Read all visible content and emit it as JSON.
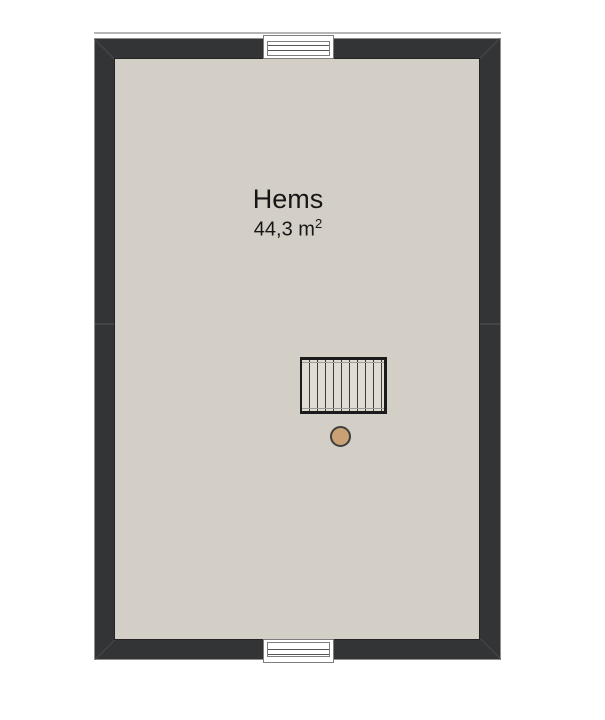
{
  "room": {
    "name": "Hems",
    "area_value": "44,3 m",
    "area_exponent": "2"
  },
  "colors": {
    "background": "#ffffff",
    "wall": "#333436",
    "wall_outline": "#8f8f8f",
    "wall_joint": "#4a4a4a",
    "wall_seam": "#454545",
    "eave_line": "#b6b6b6",
    "floor": "#d4cfc6",
    "window_fill": "#ffffff",
    "window_frame": "#7d7d7d",
    "glass_line": "#555555",
    "stair_fill": "#e0dcd4",
    "stair_border": "#1b1b1b",
    "stair_tread": "#3a3a3a",
    "stair_stringer": "#9c9c9c",
    "post_fill": "#c9a175",
    "post_border": "#3f3f3f",
    "text": "#161616"
  }
}
